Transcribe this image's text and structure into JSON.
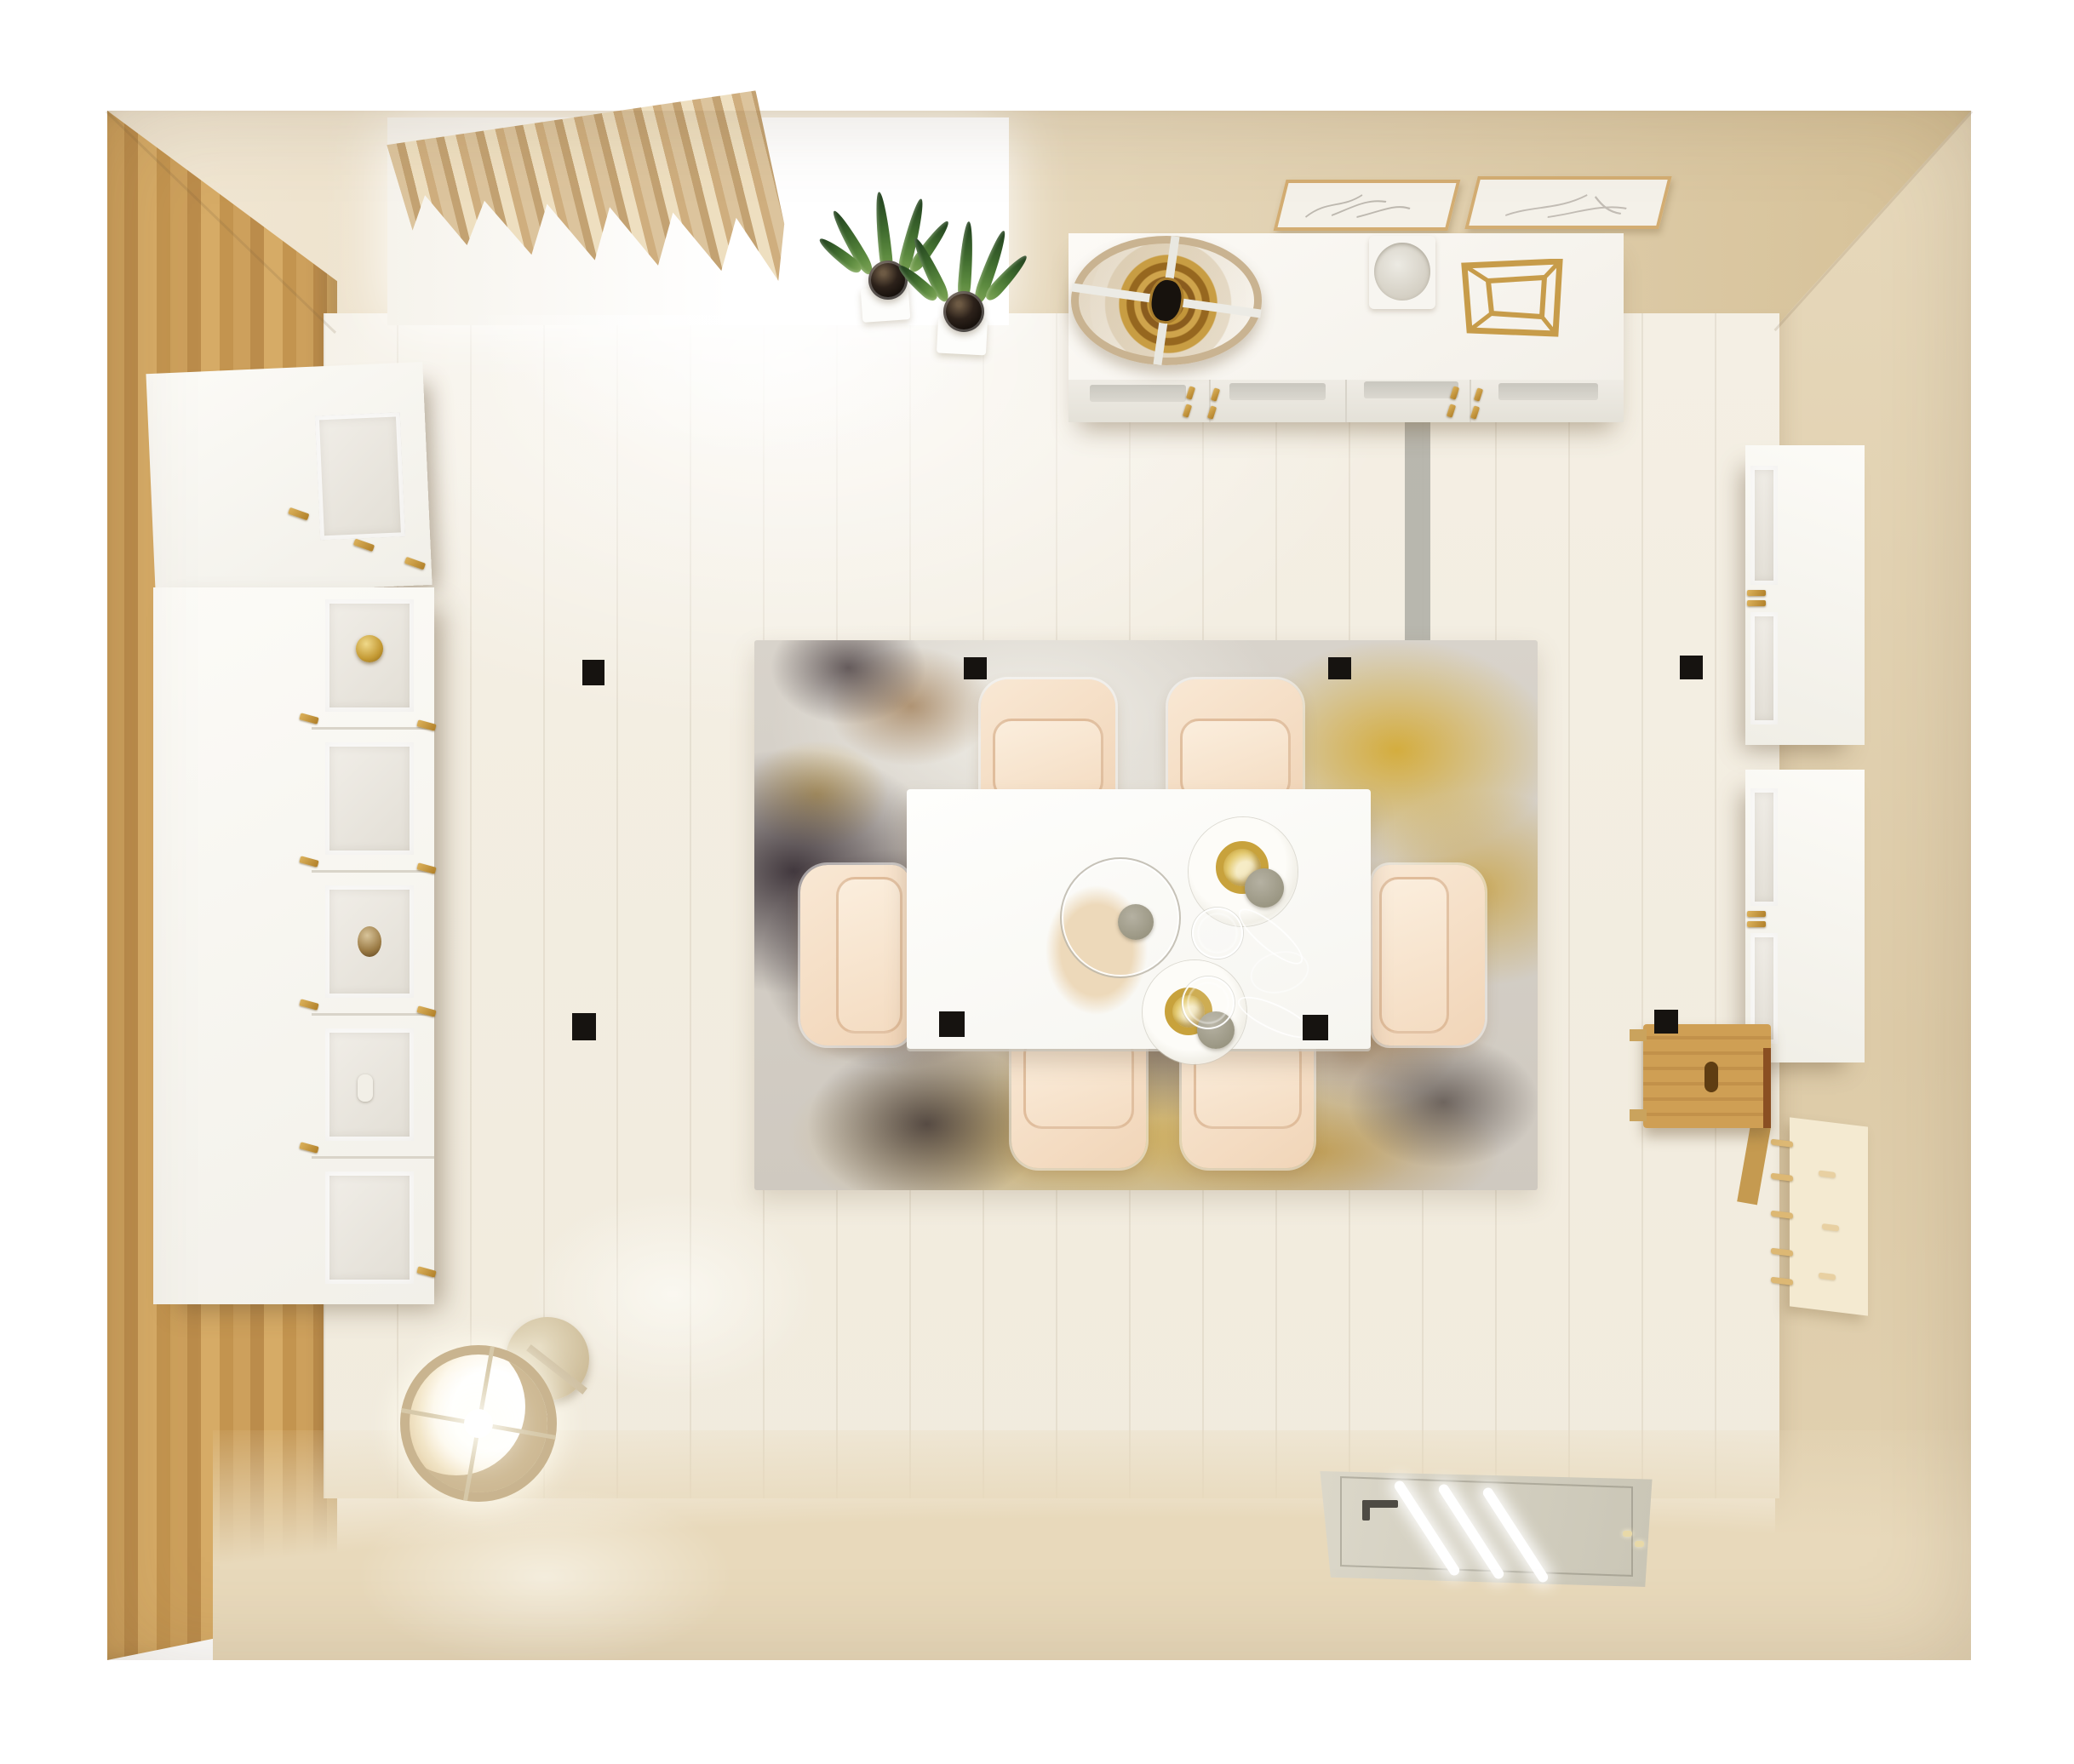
{
  "meta": {
    "type": "3d-interior-render",
    "view": "top-down",
    "room": "dining room",
    "caption": "Photorealistic bird's-eye render of a cream dining room with white furniture and gold accents"
  },
  "palette": {
    "background": "#ffffff",
    "wall_cream": "#e6d6b6",
    "wood_floor": "#c79c58",
    "plank_floor": "#f3eee3",
    "beige_floor": "#e7d8ba",
    "accent_gold": "#c59b42",
    "rug_gold": "#d4a41c",
    "rug_dark": "#2b222a",
    "chair_cream": "#f6dfc9",
    "table_white": "#fcfcfa",
    "ceiling_light_black": "#161310",
    "plant_green": "#3f6b2e"
  },
  "objects": {
    "room": {
      "label": "Top-down dining room render"
    },
    "window": {
      "label": "Window with daylight"
    },
    "curtain": {
      "label": "Beige pleated curtain"
    },
    "plants": {
      "label": "Two potted snake plants",
      "count": 2
    },
    "sideboard": {
      "label": "White sideboard with four doors",
      "doors": 4,
      "handle_color": "#c59b42"
    },
    "sideboard_lamp": {
      "label": "Round lamp with gold interior on sideboard"
    },
    "prints": {
      "label": "Two framed botanical prints",
      "count": 2
    },
    "decor_cube": {
      "label": "Gold wireframe cube decor"
    },
    "bowl": {
      "label": "White bowl on tray"
    },
    "runner": {
      "label": "Gray floor channel strip"
    },
    "rug": {
      "label": "Abstract rug in gray, gold and black"
    },
    "dining_table": {
      "label": "White rectangular dining table"
    },
    "chairs": {
      "label": "Cream upholstered dining chairs",
      "count": 6
    },
    "tableware": {
      "label": "Glass charger, two gold-rimmed plates, two wine glasses"
    },
    "left_wall_cabinet": {
      "label": "White wall cabinet with glass door"
    },
    "left_cabinet_stack": {
      "label": "Stacked white display cabinets with glass doors",
      "doors": 5
    },
    "right_cabinets": {
      "label": "Two white wall cabinets with frosted doors",
      "count": 2
    },
    "stool": {
      "label": "Wooden wall-mounted shelf"
    },
    "pegboard": {
      "label": "Peg rail with wooden pegs"
    },
    "floor_lamp": {
      "label": "Glowing drum floor lamp"
    },
    "door": {
      "label": "Door with glowing glass slats"
    },
    "ceiling_lights": {
      "label": "Recessed ceiling spotlights",
      "count": 8
    }
  }
}
